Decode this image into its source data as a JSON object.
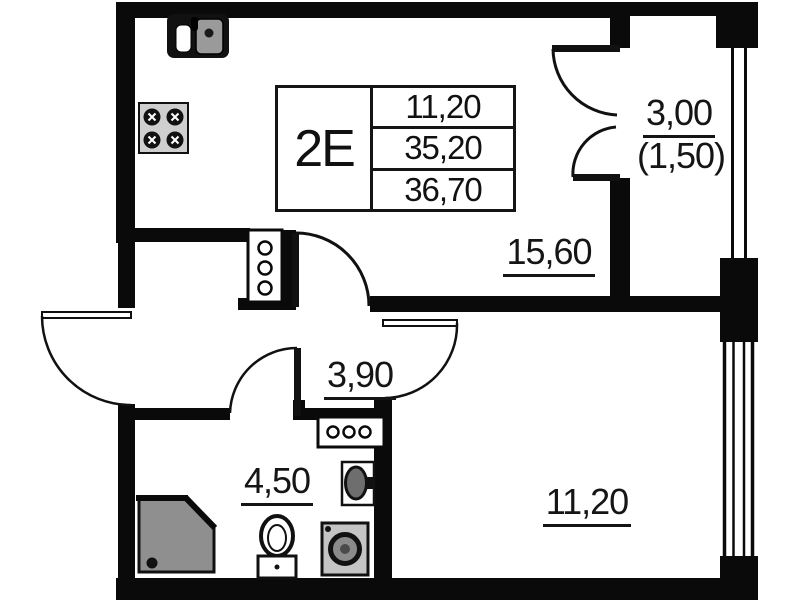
{
  "unit_table": {
    "unit_label": "2E",
    "rows": [
      "11,20",
      "35,20",
      "36,70"
    ]
  },
  "rooms": {
    "living_kitchen": {
      "area": "15,60"
    },
    "balcony": {
      "area": "3,00",
      "area_reduced": "(1,50)"
    },
    "hallway": {
      "area": "3,90"
    },
    "bathroom": {
      "area": "4,50"
    },
    "bedroom": {
      "area": "11,20"
    }
  },
  "fixtures": [
    "kitchen-sink",
    "stove",
    "vent-shaft-vertical",
    "vent-shaft-horizontal",
    "shower-tray",
    "toilet",
    "washing-machine",
    "washbasin",
    "balcony-window",
    "bedroom-window"
  ],
  "colors": {
    "wall": "#0a0a0a",
    "background": "#ffffff",
    "fixture_gray": "#8f8f8f",
    "appliance_gray": "#cfcfcf"
  }
}
